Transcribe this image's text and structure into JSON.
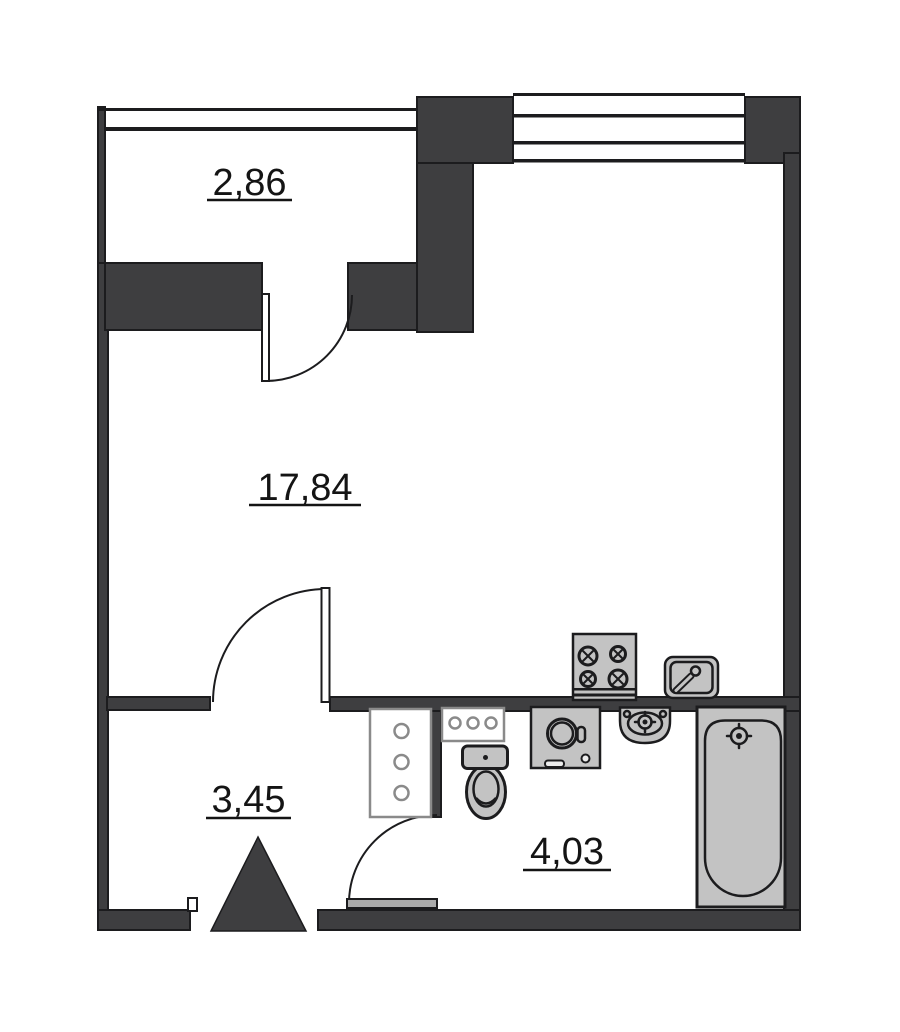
{
  "document": {
    "type": "apartment-floor-plan"
  },
  "colors": {
    "wall": "#3e3e40",
    "outline": "#1c1c1e",
    "fixture": "#c3c3c3",
    "fixture_light": "#ececec",
    "panel_border": "#8a8a8a",
    "leaf": "#ffffff",
    "door_leaf_gray": "#ababab",
    "background": "#ffffff",
    "label": "#141414"
  },
  "rooms": [
    {
      "name": "balcony",
      "area_label": "2,86"
    },
    {
      "name": "living-room",
      "area_label": "17,84"
    },
    {
      "name": "hallway",
      "area_label": "3,45"
    },
    {
      "name": "bathroom",
      "area_label": "4,03"
    }
  ],
  "fixtures": [
    "stove-icon",
    "kitchen-sink-icon",
    "washing-machine-icon",
    "wash-basin-icon",
    "bathtub-icon",
    "toilet-icon",
    "shelf-column-icon",
    "shelf-panel-icon",
    "entrance-arrow-icon",
    "door-swing-icon",
    "window-icon"
  ]
}
